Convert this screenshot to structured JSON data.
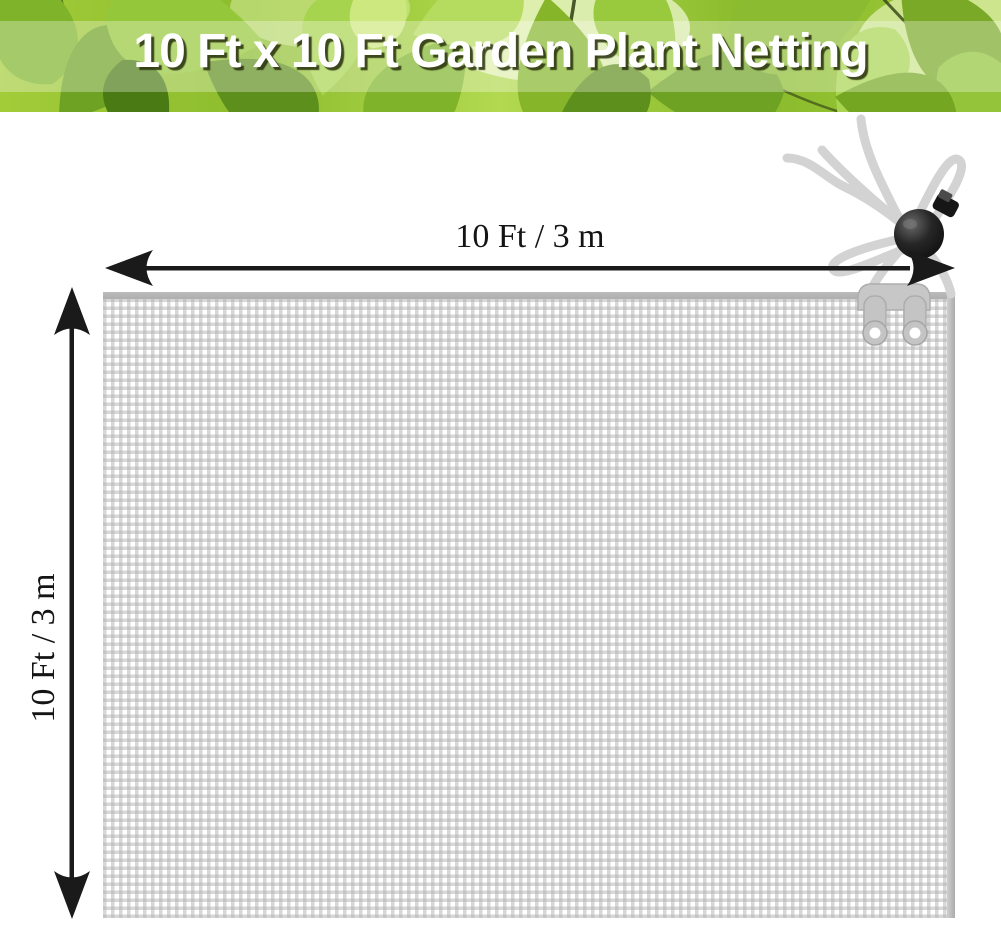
{
  "banner": {
    "title": "10 Ft x 10 Ft Garden Plant Netting"
  },
  "dimensions": {
    "width_label": "10 Ft / 3 m",
    "height_label": "10 Ft / 3 m"
  },
  "colors": {
    "background": "#ffffff",
    "banner_green": "#8fbe2e",
    "title_text": "#ffffff",
    "title_shadow": "#2a320e",
    "label_text": "#141414",
    "arrow": "#1a1a1a",
    "net_line": "#b0b0b0",
    "net_hem": "#aeaeae",
    "rope": "#d3d3d3",
    "toggle": "#1b1b1b",
    "clip": "#c7c7c7"
  }
}
